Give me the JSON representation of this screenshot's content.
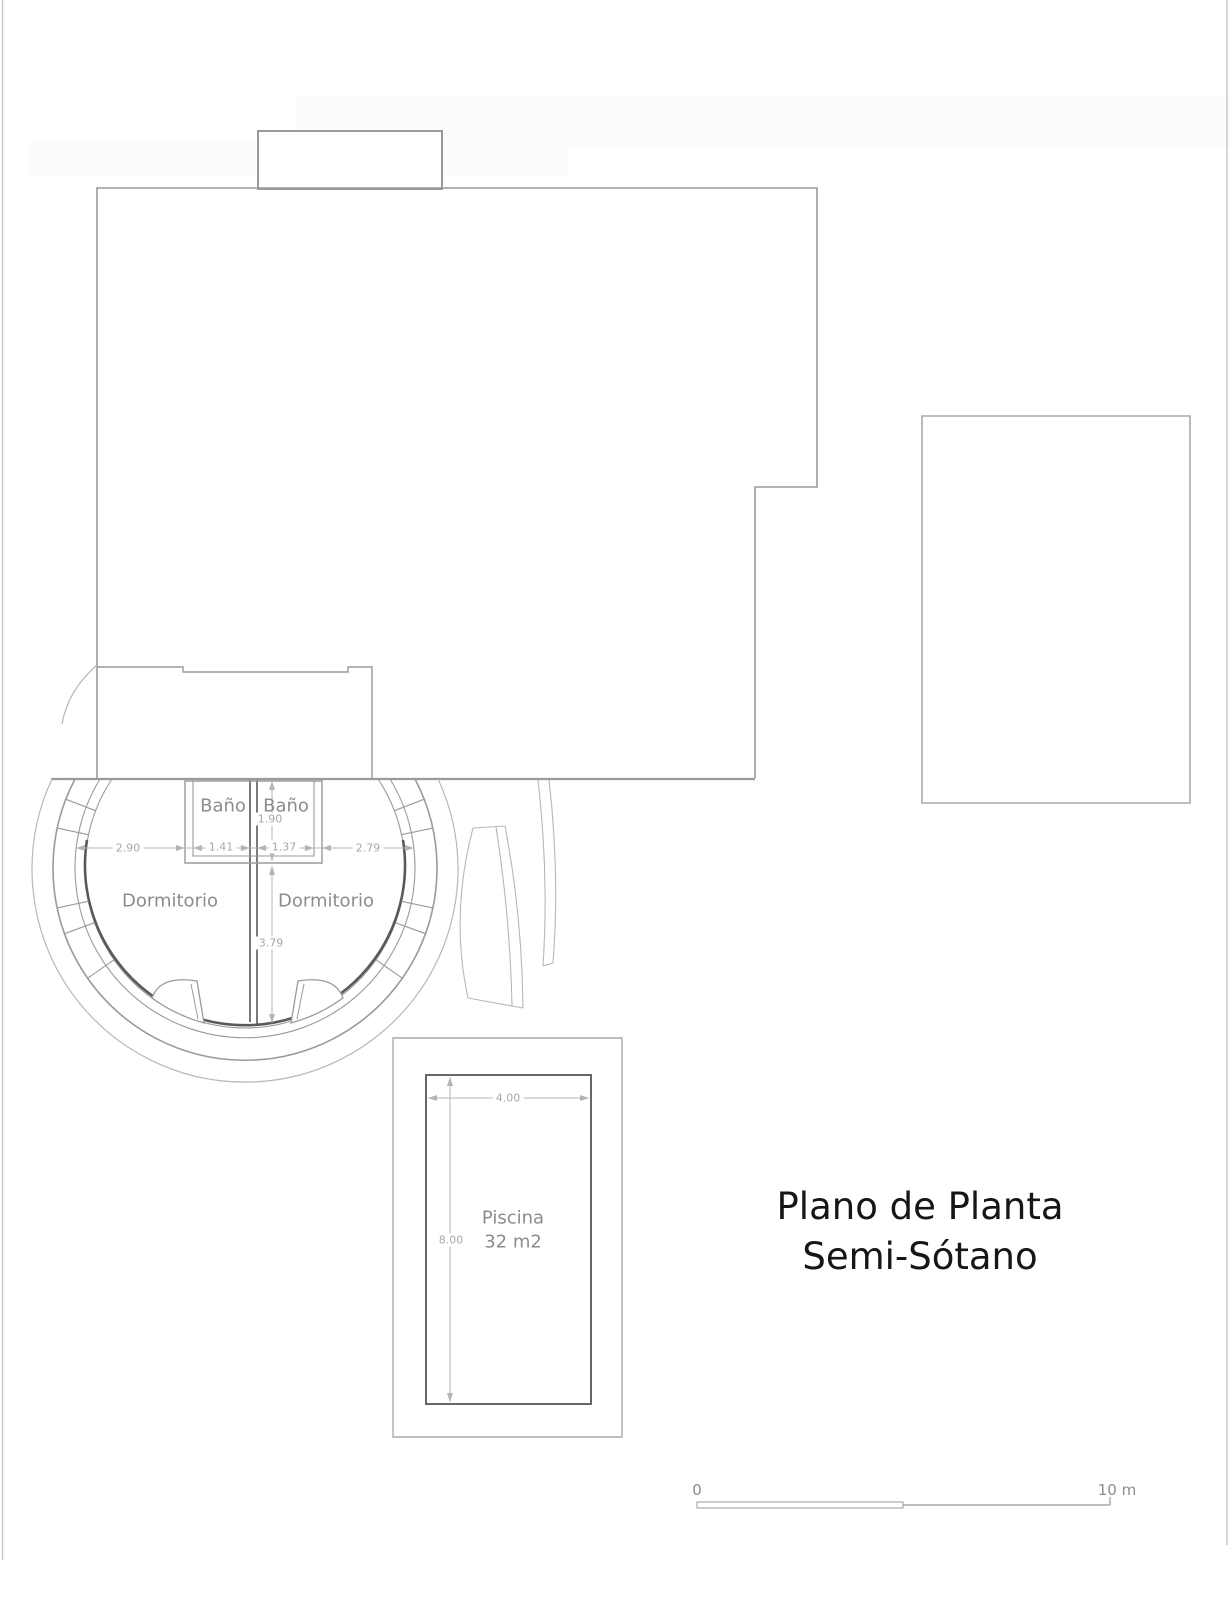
{
  "document": {
    "title_line1": "Plano de Planta",
    "title_line2": "Semi-Sótano"
  },
  "rooms": {
    "bath_left": "Baño",
    "bath_right": "Baño",
    "bedroom_left": "Dormitorio",
    "bedroom_right": "Dormitorio",
    "pool_name": "Piscina",
    "pool_area": "32 m2"
  },
  "dimensions": {
    "bedroom_left_width": "2.90",
    "bath_left_width": "1.41",
    "bath_right_width": "1.37",
    "bedroom_right_width": "2.79",
    "bath_depth": "1.90",
    "bedroom_depth": "3.79",
    "pool_width": "4.00",
    "pool_length": "8.00"
  },
  "scale_bar": {
    "start_label": "0",
    "end_label": "10 m"
  },
  "colors": {
    "line-gray": "#9a9a9a",
    "light-gray": "#b8b8b8",
    "dark-gray": "#5a5a5a",
    "dim-gray": "#b4b4b4",
    "label-gray": "#8c8c8c",
    "dim-label-gray": "#a8a8a8",
    "title-black": "#161616"
  }
}
